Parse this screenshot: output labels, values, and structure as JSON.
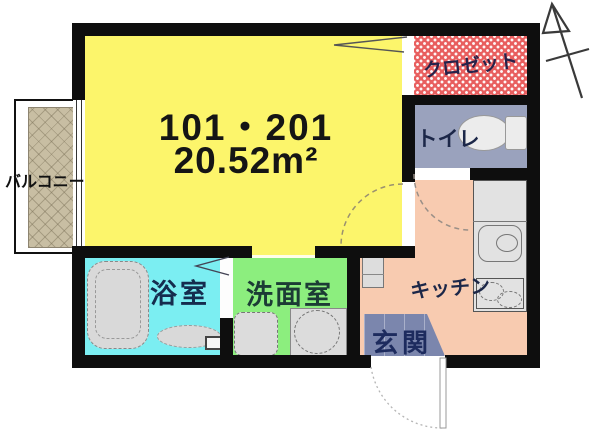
{
  "floorplan": {
    "unit_label": "101・201",
    "area_label": "20.52m²",
    "rooms": {
      "balcony": {
        "label": "バルコニー",
        "color": "#c8bea3"
      },
      "main": {
        "color": "#fcf56b"
      },
      "closet": {
        "label": "クロゼット",
        "color": "#e85f5f"
      },
      "toilet": {
        "label": "トイレ",
        "color": "#9aa2bd"
      },
      "kitchen": {
        "label": "キッチン",
        "color": "#f8cbb0"
      },
      "entrance": {
        "label": "玄関",
        "color": "#7b86ad"
      },
      "bathroom": {
        "label": "浴室",
        "color": "#7beef2"
      },
      "washroom": {
        "label": "洗面室",
        "color": "#8cee7e"
      }
    },
    "wall_color": "#0e0e0e",
    "compass_icon": "north-arrow"
  }
}
